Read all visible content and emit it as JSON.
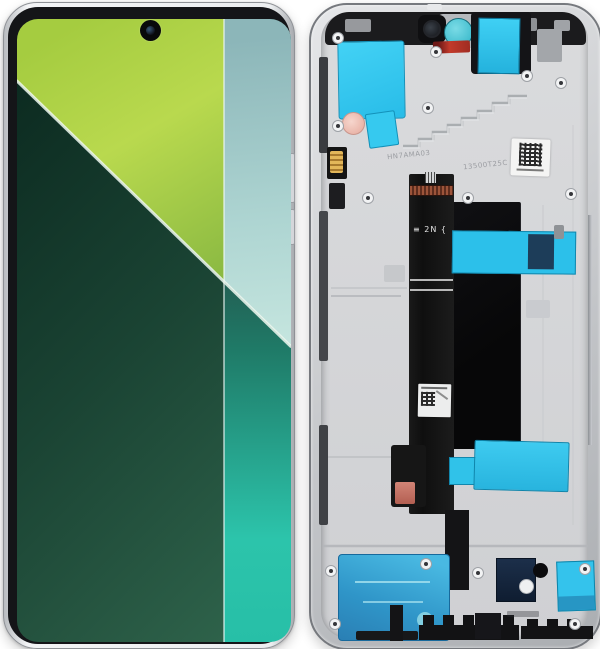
{
  "image": {
    "type": "product-photo",
    "subject": "Smartphone LCD display assembly: front screen (left) and rear mid-frame with flex cable (right)",
    "background_color": "#ffffff"
  },
  "phone": {
    "bezel_color": "#141518",
    "frame_color": "#eceef0",
    "camera": "punch-hole-camera",
    "wallpaper": {
      "style": "diagonal color-split with vertical right stripe",
      "lime": "#aed045",
      "dark_green": "#16402f",
      "mint_stripe_top": "#bfe3dc",
      "teal_stripe_bottom": "#2cc3a9",
      "diagonal_line": "#eef8f0"
    }
  },
  "frame": {
    "metal_color": "#caccd0",
    "plate_color": "#d6d7d9",
    "tape_cyan": "#2fc3ee",
    "speaker_tape_blue": "#2f95c8",
    "camera_ring_teal": "#3ec8d8",
    "warranty_sticker_red": "#c23a2b",
    "flex_cable_color": "#151514",
    "markings": {
      "etched_left": "HN7AMA03",
      "etched_right": "13500T25C",
      "flex_code": "≡ 2N {"
    }
  }
}
